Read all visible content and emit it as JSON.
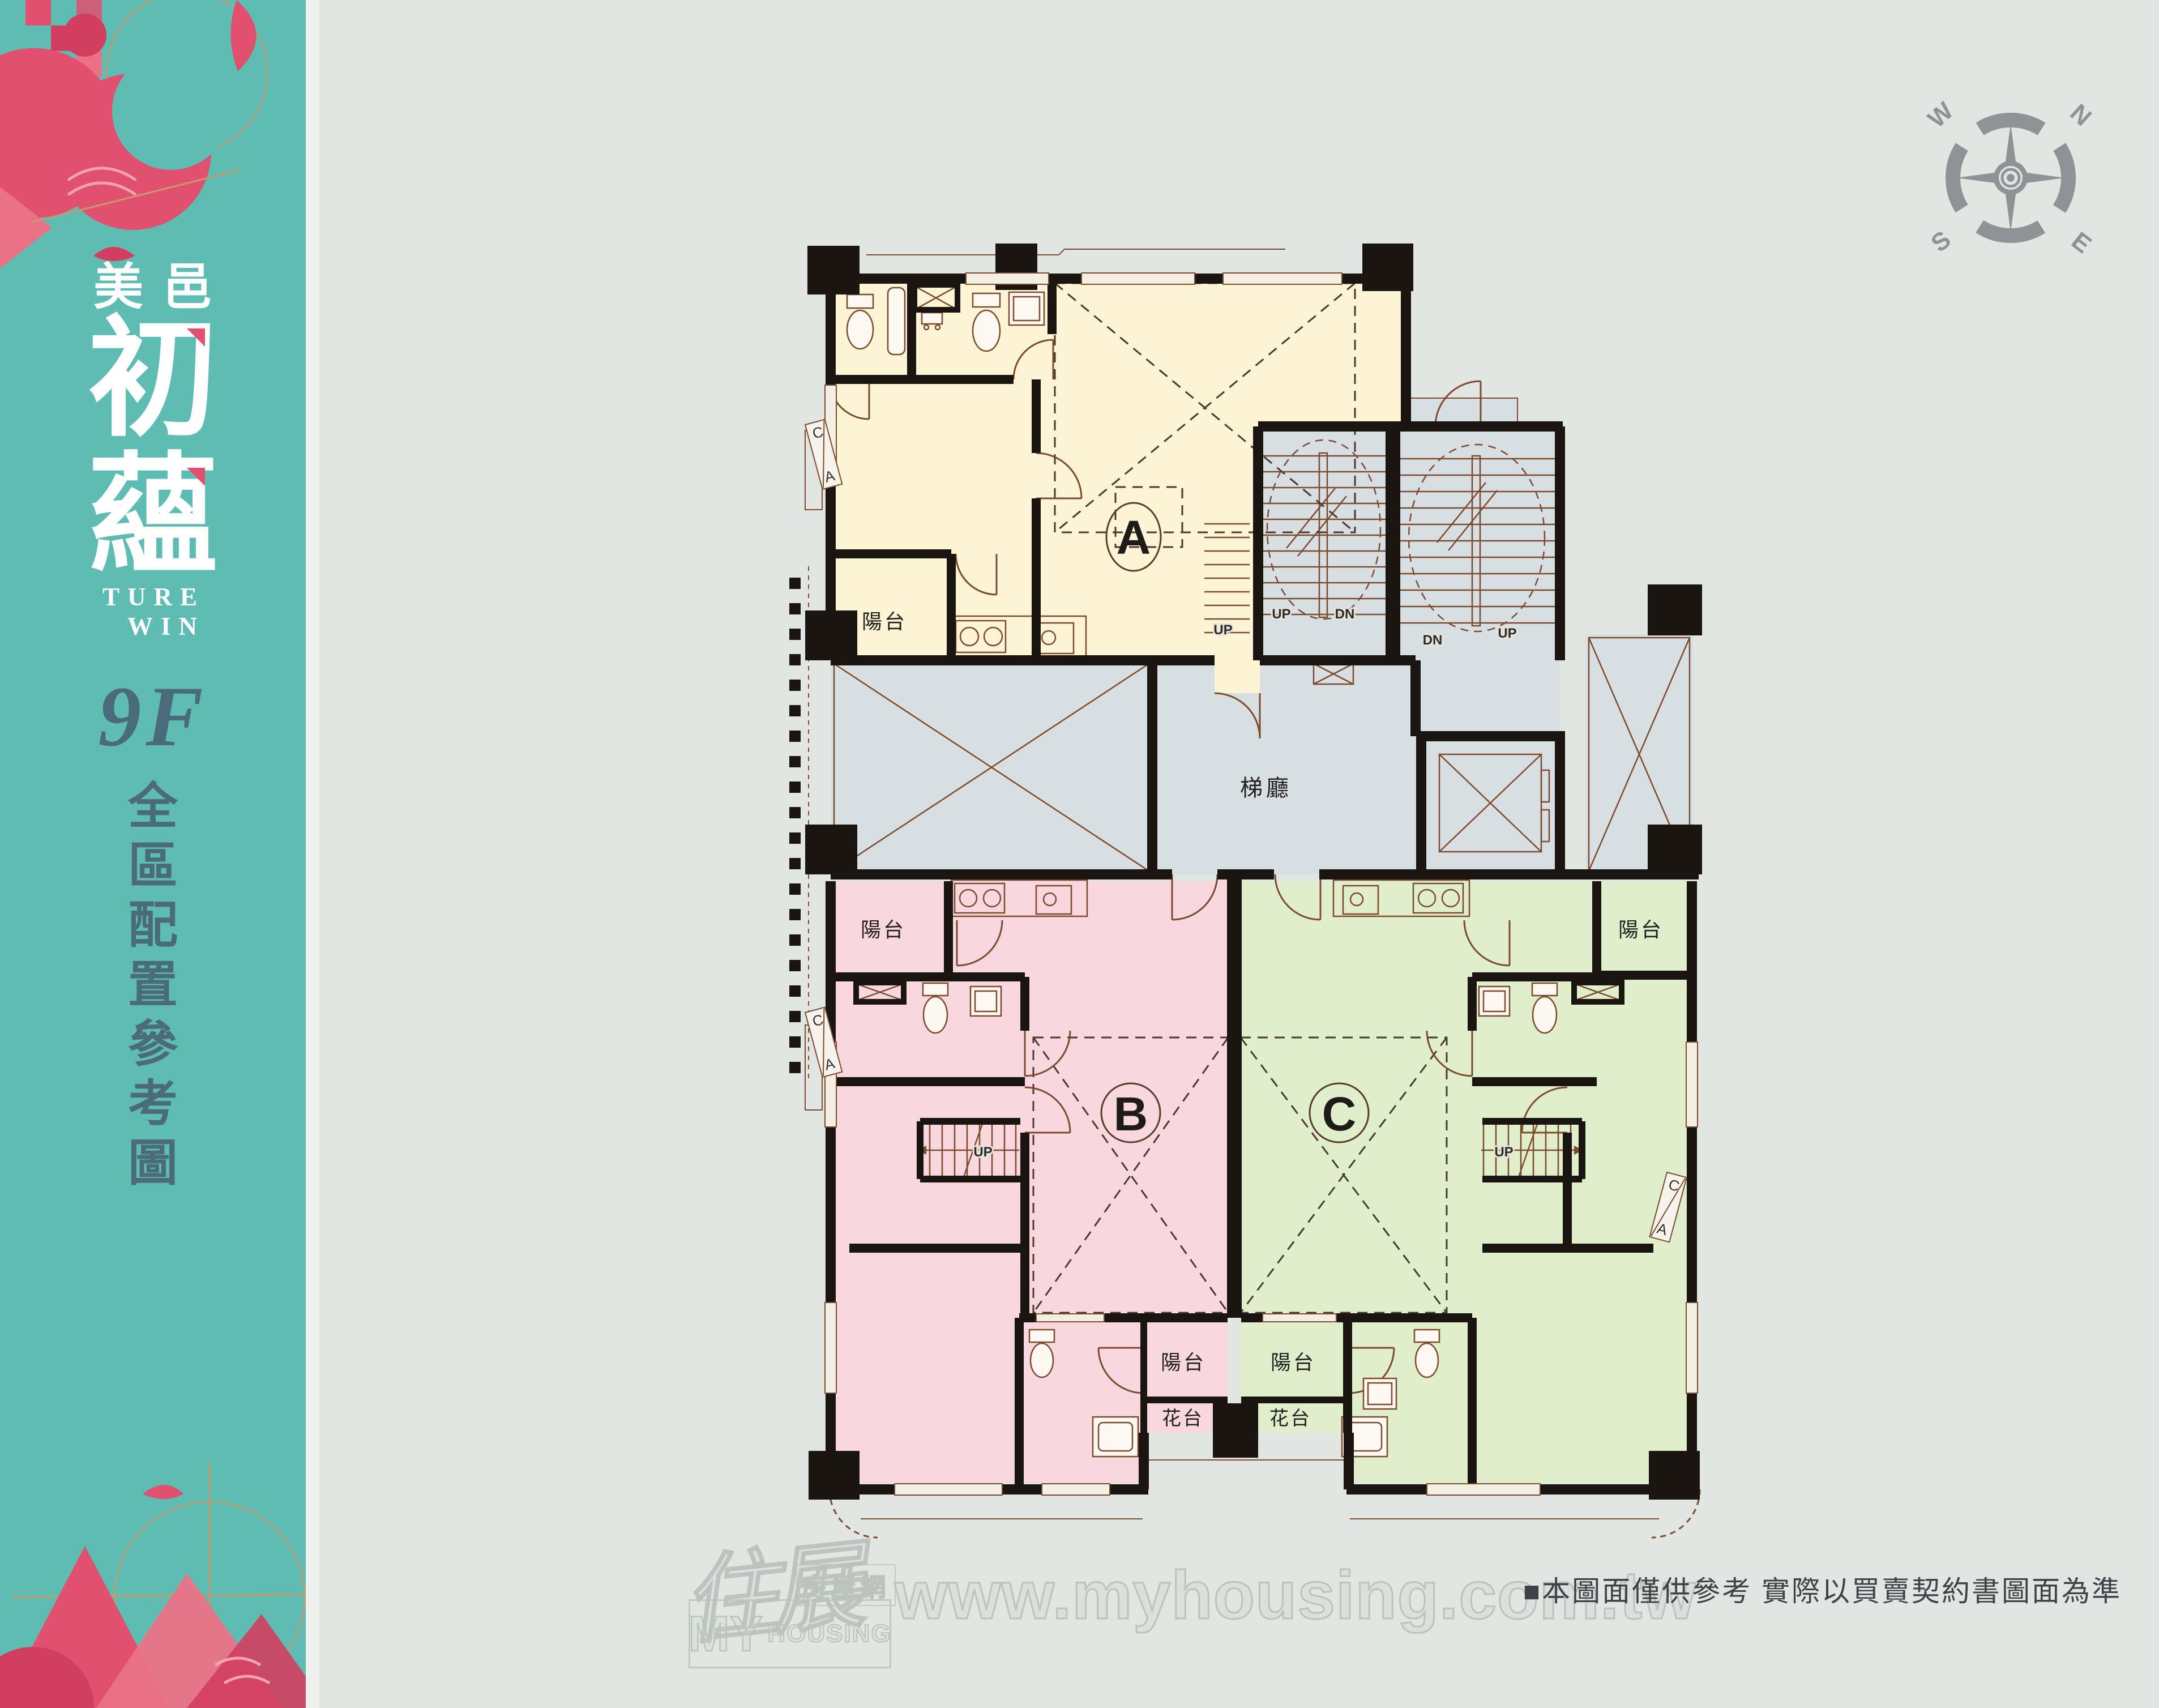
{
  "sidebar": {
    "brand_prefix": "美邑",
    "brand_char1": "初",
    "brand_char2": "蘊",
    "brand_en_line1": "TURE",
    "brand_en_line2": "WIN",
    "floor_label": "9F",
    "subtitle_chars": [
      "全",
      "區",
      "配",
      "置",
      "參",
      "考",
      "圖"
    ],
    "colors": {
      "teal": "#5fbcb3",
      "accent_pink": "#e1506e",
      "dark_slate": "#4a6b7a",
      "tan": "#c49a6e"
    }
  },
  "compass": {
    "n": "N",
    "e": "E",
    "s": "S",
    "w": "W",
    "color": "#8e9396"
  },
  "plan": {
    "unit_a": "A",
    "unit_b": "B",
    "unit_c": "C",
    "labels": {
      "balcony": "陽台",
      "flower_bed": "花台",
      "stair_hall": "梯廳",
      "up": "UP",
      "down": "DN"
    },
    "section": {
      "c": "C",
      "a": "A"
    },
    "colors": {
      "unit_a": "#fcf4d4",
      "unit_b": "#f9d7de",
      "unit_c": "#dfeecb",
      "common": "#d8dfe2",
      "wall": "#1a1511",
      "line": "#7d4a2e"
    }
  },
  "footer": {
    "disclaimer": "■本圖面僅供參考 實際以買賣契約書圖面為準",
    "watermark": {
      "script": "住展",
      "label": "房屋網",
      "my": "MY",
      "housing": "HOUSING",
      "url": "www.myhousing.com.tw"
    }
  }
}
